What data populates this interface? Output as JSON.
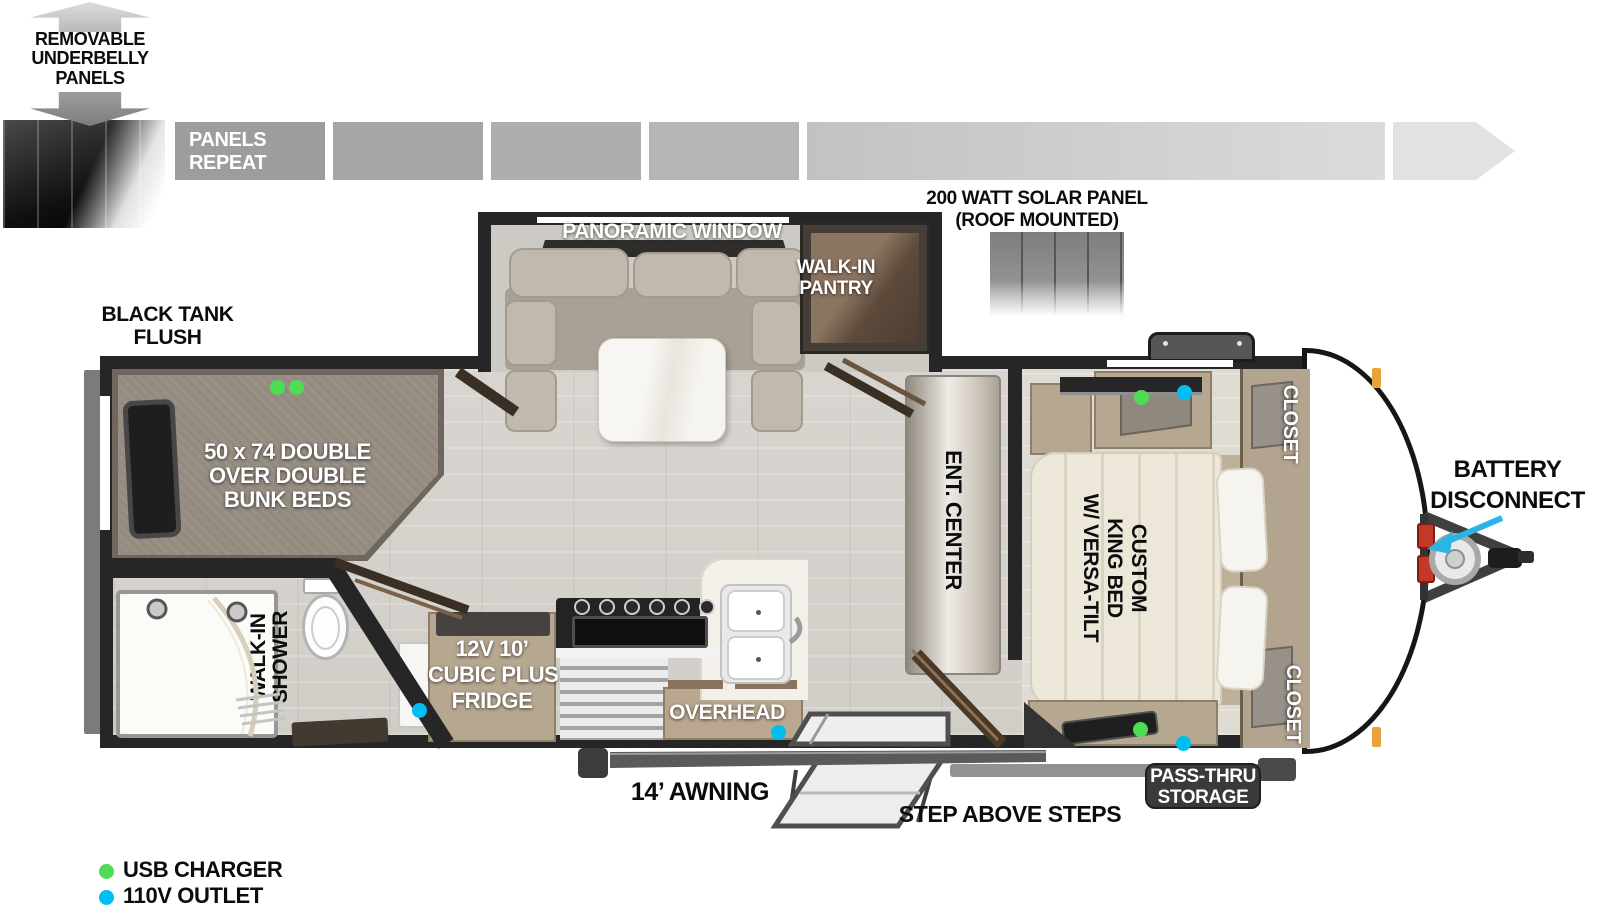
{
  "underbelly": {
    "line1": "REMOVABLE",
    "line2": "UNDERBELLY",
    "line3": "PANELS"
  },
  "roof": {
    "panels_repeat": "PANELS REPEAT",
    "solar_line1": "200 WATT SOLAR PANEL",
    "solar_line2": "(ROOF MOUNTED)"
  },
  "exterior": {
    "black_tank_line1": "BLACK TANK",
    "black_tank_line2": "FLUSH",
    "battery_line1": "BATTERY",
    "battery_line2": "DISCONNECT",
    "battery_arrow_color": "#2ab5e6",
    "awning": "14’ AWNING",
    "steps": "STEP ABOVE STEPS",
    "pass_thru_line1": "PASS-THRU",
    "pass_thru_line2": "STORAGE"
  },
  "interior": {
    "panoramic_window": "PANORAMIC WINDOW",
    "pantry_line1": "WALK-IN",
    "pantry_line2": "PANTRY",
    "bunk_line1": "50 x 74 DOUBLE",
    "bunk_line2": "OVER DOUBLE",
    "bunk_line3": "BUNK BEDS",
    "shower_line1": "WALK-IN",
    "shower_line2": "SHOWER",
    "fridge_line1": "12V 10’",
    "fridge_line2": "CUBIC PLUS",
    "fridge_line3": "FRIDGE",
    "overhead": "OVERHEAD",
    "ent_center": "ENT. CENTER",
    "bed_line1": "CUSTOM",
    "bed_line2": "KING BED",
    "bed_line3": "W/ VERSA-TILT",
    "closet_top": "CLOSET",
    "closet_bottom": "CLOSET"
  },
  "legend": {
    "items": [
      {
        "label": "USB CHARGER",
        "color": "#4edc55"
      },
      {
        "label": "110V OUTLET",
        "color": "#00bdf2"
      }
    ]
  }
}
